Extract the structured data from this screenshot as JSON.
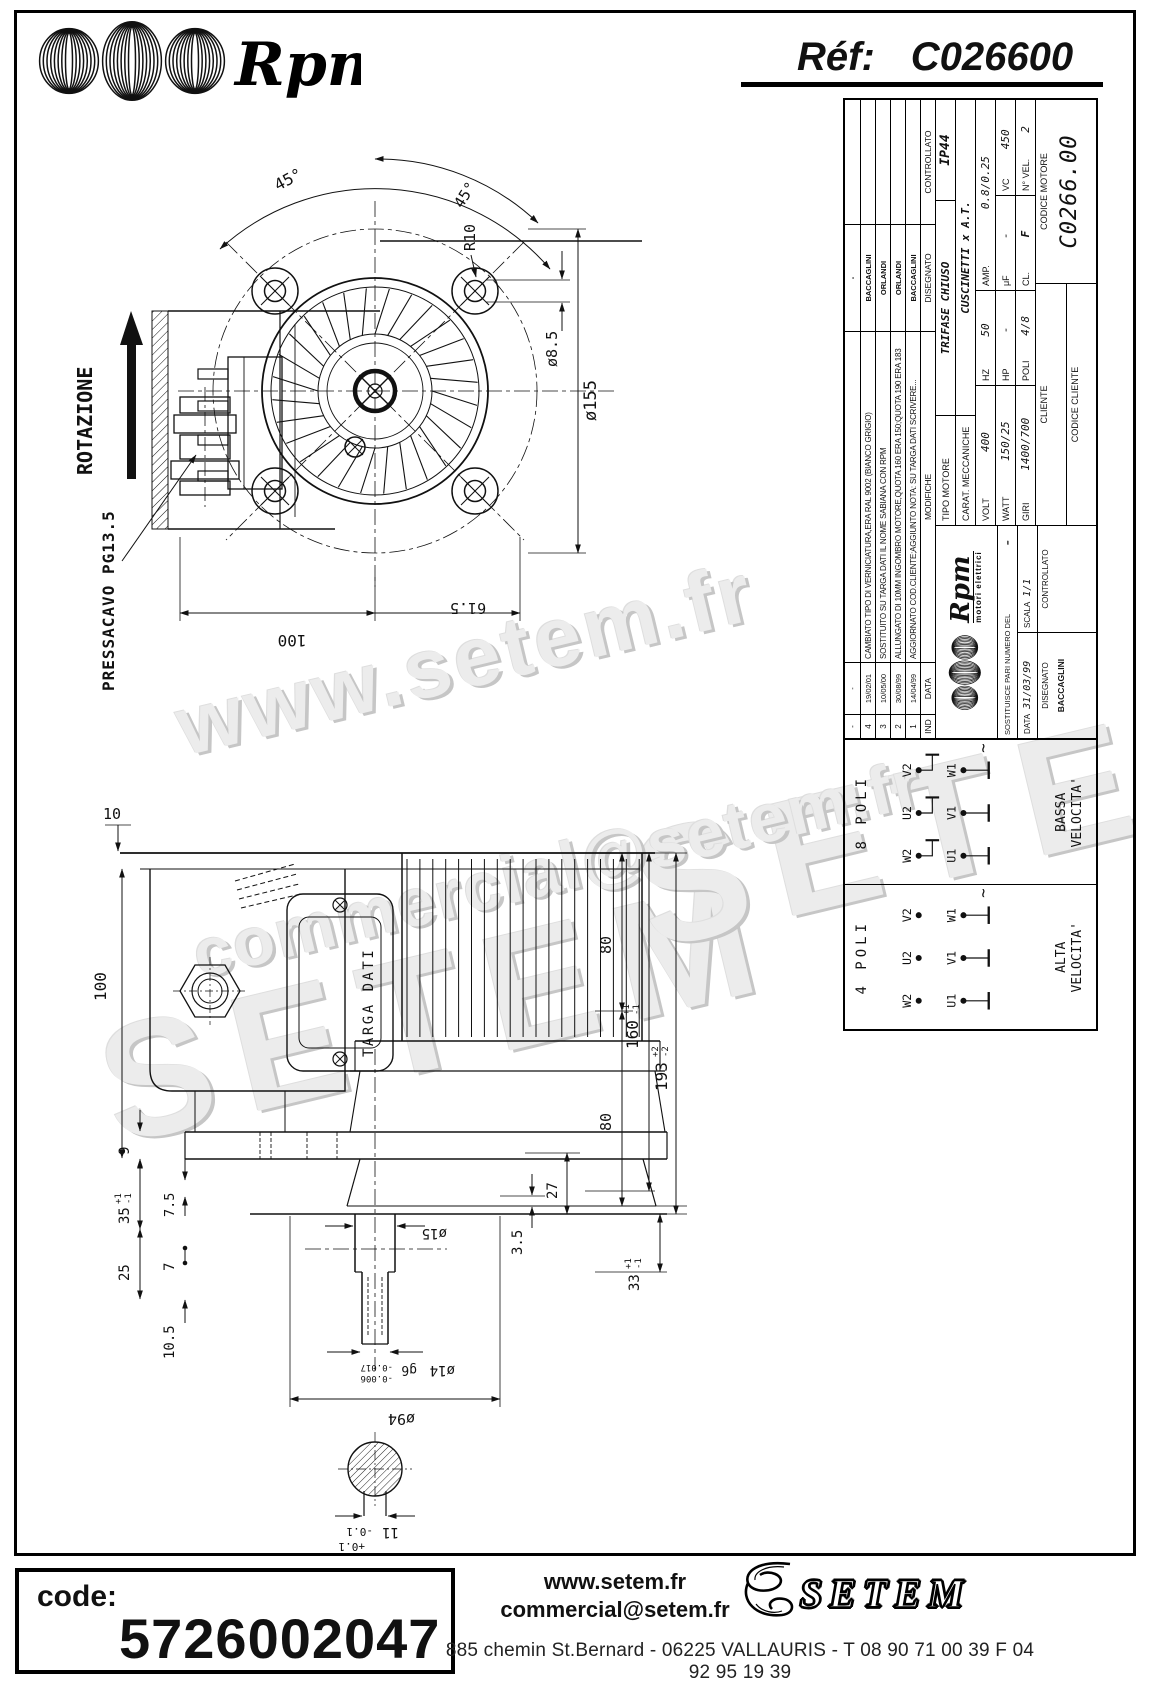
{
  "header": {
    "brand": "Rpm",
    "ref_label": "Réf:",
    "ref_value": "C026600"
  },
  "watermarks": {
    "web": "www.setem.fr",
    "brand_left": "SETEM",
    "brand_right": "SETEM",
    "email": "commercial@setem.fr"
  },
  "front_view": {
    "rotation_label": "ROTAZIONE",
    "gland_label": "PRESSACAVO PG13.5",
    "angle_left": "45°",
    "angle_right": "45°",
    "lug_radius": "R10",
    "lug_hole_dia": "ø8.5",
    "body_dia": "ø155",
    "width_left": "100",
    "width_right": "61.5"
  },
  "side_view": {
    "plate_label": "TARGA DATI",
    "top_offset": "10",
    "box_height": "100",
    "foot_thickness": "9",
    "h35": "35",
    "h35_tol_plus": "+1",
    "h35_tol_minus": "-1",
    "h75": "7.5",
    "h7": "7",
    "h25": "25",
    "h105": "10.5",
    "len80_top": "80",
    "len80_bottom": "80",
    "len160": "160",
    "len160_tol_plus": "+1",
    "len160_tol_minus": "-1",
    "len193": "193",
    "len193_tol_plus": "+2",
    "len193_tol_minus": "-2",
    "h27": "27",
    "h35b": "3.5",
    "h33": "33",
    "h33_tol_plus": "+1",
    "h33_tol_minus": "-1",
    "shaft_dia_upper": "ø15",
    "shaft_dia": "ø14",
    "shaft_fit": "g6",
    "shaft_fit_upper": "-0.006",
    "shaft_fit_lower": "-0.017",
    "flange_dia": "ø94",
    "key_width": "11",
    "key_tol_plus": "+0.1",
    "key_tol_minus": "-0.1"
  },
  "titleblock": {
    "history": {
      "header": {
        "ind": "IND",
        "date": "DATA",
        "text": "MODIFICHE",
        "drawn": "DISEGNATO",
        "checked": "CONTROLLATO"
      },
      "rows": [
        {
          "ind": "-",
          "date": "-",
          "text": "",
          "drawn": "-",
          "checked": ""
        },
        {
          "ind": "4",
          "date": "19/02/01",
          "text": "CAMBIATO TIPO DI VERNICIATURA,ERA RAL 9002 (BIANCO GRIGIO)",
          "drawn": "BACCAGLINI",
          "checked": ""
        },
        {
          "ind": "3",
          "date": "10/05/00",
          "text": "SOSTITUITO SU TARGA DATI IL NOME SABIANA CON RPM",
          "drawn": "ORLANDI",
          "checked": ""
        },
        {
          "ind": "2",
          "date": "30/08/99",
          "text": "ALLUNGATO DI 10MM INGOMBRO MOTORE,QUOTA 160 ERA 150;QUOTA 190 ERA 183",
          "drawn": "ORLANDI",
          "checked": ""
        },
        {
          "ind": "1",
          "date": "14/04/99",
          "text": "AGGIORNATO COD.CLIENTE;AGGIUNTO NOTA: SU TARGA DATI SCRIVERE...",
          "drawn": "BACCAGLINI",
          "checked": ""
        }
      ]
    },
    "motor_type_label": "TIPO MOTORE",
    "motor_type": "TRIFASE CHIUSO",
    "protection": "IP44",
    "mech_label": "CARAT. MECCANICHE",
    "mech": "CUSCINETTI x A.T.",
    "volt_label": "VOLT",
    "volt": "400",
    "hz_label": "HZ",
    "hz": "50",
    "amp_label": "AMP.",
    "amp": "0.8/0.25",
    "watt_label": "WATT",
    "watt": "150/25",
    "hp_label": "HP",
    "hp": "-",
    "uf_label": "μF",
    "uf": "-",
    "vc_label": "VC",
    "vc": "450",
    "giri_label": "GIRI",
    "giri": "1400/700",
    "poli_label": "POLI",
    "poli": "4/8",
    "cl_label": "CL.",
    "cl": "F",
    "nvel_label": "N° VEL.",
    "nvel": "2",
    "logo_text": "Rpm",
    "logo_sub": "motori elettrici",
    "replaces_label": "SOSTITUISCE PARI NUMERO DEL",
    "replaces_value": "-",
    "date_label": "DATA",
    "date_value": "31/03/99",
    "scale_label": "SCALA",
    "scale_value": "1/1",
    "drawn_label": "DISEGNATO",
    "drawn_value": "BACCAGLINI",
    "checked_label": "CONTROLLATO",
    "client_label": "CLIENTE",
    "client_code_label": "CODICE CLIENTE",
    "motor_code_label": "CODICE MOTORE",
    "motor_code": "C0266.00"
  },
  "wiring": {
    "cells": [
      {
        "title": "4 POLI",
        "t1": "W2",
        "t2": "U2",
        "t3": "V2",
        "b1": "U1",
        "b2": "V1",
        "b3": "W1",
        "ac": "~",
        "speed1": "ALTA",
        "speed2": "VELOCITA'"
      },
      {
        "title": "8 POLI",
        "t1": "W2",
        "t2": "U2",
        "t3": "V2",
        "b1": "U1",
        "b2": "V1",
        "b3": "W1",
        "ac": "~",
        "speed1": "BASSA",
        "speed2": "VELOCITA'"
      }
    ]
  },
  "footer": {
    "code_label": "code:",
    "code_value": "5726002047",
    "web": "www.setem.fr",
    "email": "commercial@setem.fr",
    "brand": "SETEM",
    "address": "885 chemin St.Bernard  -  06225 VALLAURIS  -  T 08 90 71 00 39   F 04 92 95 19 39"
  }
}
